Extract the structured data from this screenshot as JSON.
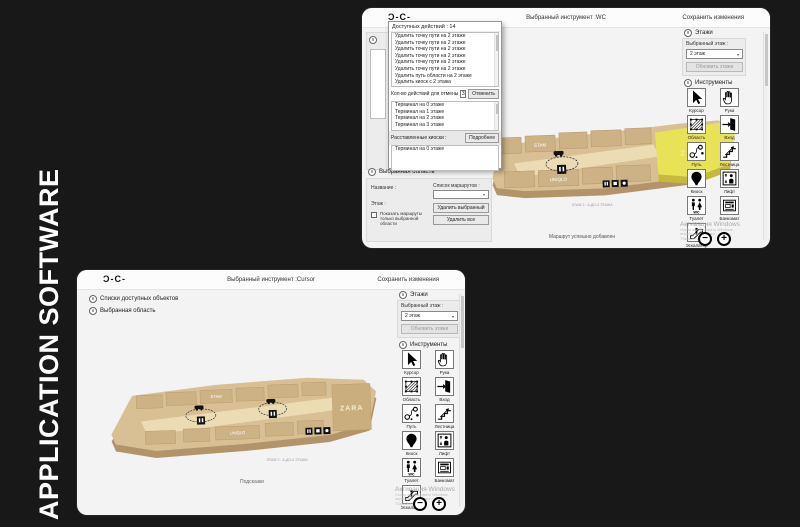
{
  "scene": {
    "side_label": "APPLICATION SOFTWARE"
  },
  "panel": {
    "floors_title": "Этажи",
    "selected_floor_label": "Выбранный этаж :",
    "selected_floor_value": "2 этаж",
    "refresh_floors_button": "Обновить этажи",
    "tools_title": "Инструменты",
    "tools": [
      "Курсор",
      "Рука",
      "Область",
      "Вход",
      "Путь",
      "Лестница",
      "Киоск",
      "Лифт",
      "Туалет",
      "Банкомат",
      "Эскалатор"
    ]
  },
  "zoom_controls": {
    "out": "−",
    "in": "+"
  },
  "watermark": {
    "title": "Активация Windows",
    "line1": "Чтобы активировать Windows, перейдите в раздел",
    "line2": "\"Параметры\"."
  },
  "map": {
    "stores": {
      "zara": "ZARA",
      "uniqlo": "UNIQLO",
      "etam": "ETAM"
    },
    "caption": "ЭТАЖ 2 : А-ДО-4 ЭТАЖА"
  },
  "win_top": {
    "logo": "Ɔ-C-",
    "title": "Выбранный инструмент :WC",
    "save_button": "Сохранить изменения",
    "actions_header": "Доступных действий : 14",
    "actions": [
      "Удалить точку пути на 2 этаже",
      "Удалить точку пути на 2 этаже",
      "Удалить точку пути на 2 этаже",
      "Удалить точку пути на 2 этаже",
      "Удалить точку пути на 2 этаже",
      "Удалить точку пути на 2 этаже",
      "Удалить путь области на 2 этаже",
      "Удалить киоск с 2 этажа"
    ],
    "undo_count_label": "Кол-во действий для отмены",
    "undo_count_value": "3",
    "undo_button": "Отменить",
    "terminals": [
      "Терминал на 0 этаже",
      "Терминал на 1 этаже",
      "Терминал на 2 этаже",
      "Терминал на 3 этаже"
    ],
    "placed_kiosks_label": "Расставленные киоски :",
    "details_button": "Подробнее",
    "placed_kiosks": [
      "Терминал на 0 этаже"
    ],
    "area": {
      "title": "Выбранная область",
      "name_label": "Название :",
      "floor_label": "Этаж :",
      "routes_label": "Список маршрутов :",
      "show_routes_label": "Показать маршруты только выбранной области",
      "delete_selected_button": "Удалить выбранный",
      "delete_all_button": "Удалить все"
    },
    "status": "Маршрут успешно добавлен"
  },
  "win_bottom": {
    "logo": "Ɔ-C-",
    "title": "Выбранный инструмент :Cursor",
    "save_button": "Сохранить изменения",
    "sections": [
      "Списки доступных объектов",
      "Выбранная область"
    ],
    "hints": "Подсказки"
  },
  "colors": {
    "background": "#181818",
    "window_bg": "#f3f3f3",
    "header_bg": "#fcfcfc",
    "map_tan": "#d8bf94",
    "map_side": "#b3946a",
    "corridor": "#ecdcb4",
    "highlight_yellow": "#e8e257",
    "watermark": "#a8a8a8"
  }
}
